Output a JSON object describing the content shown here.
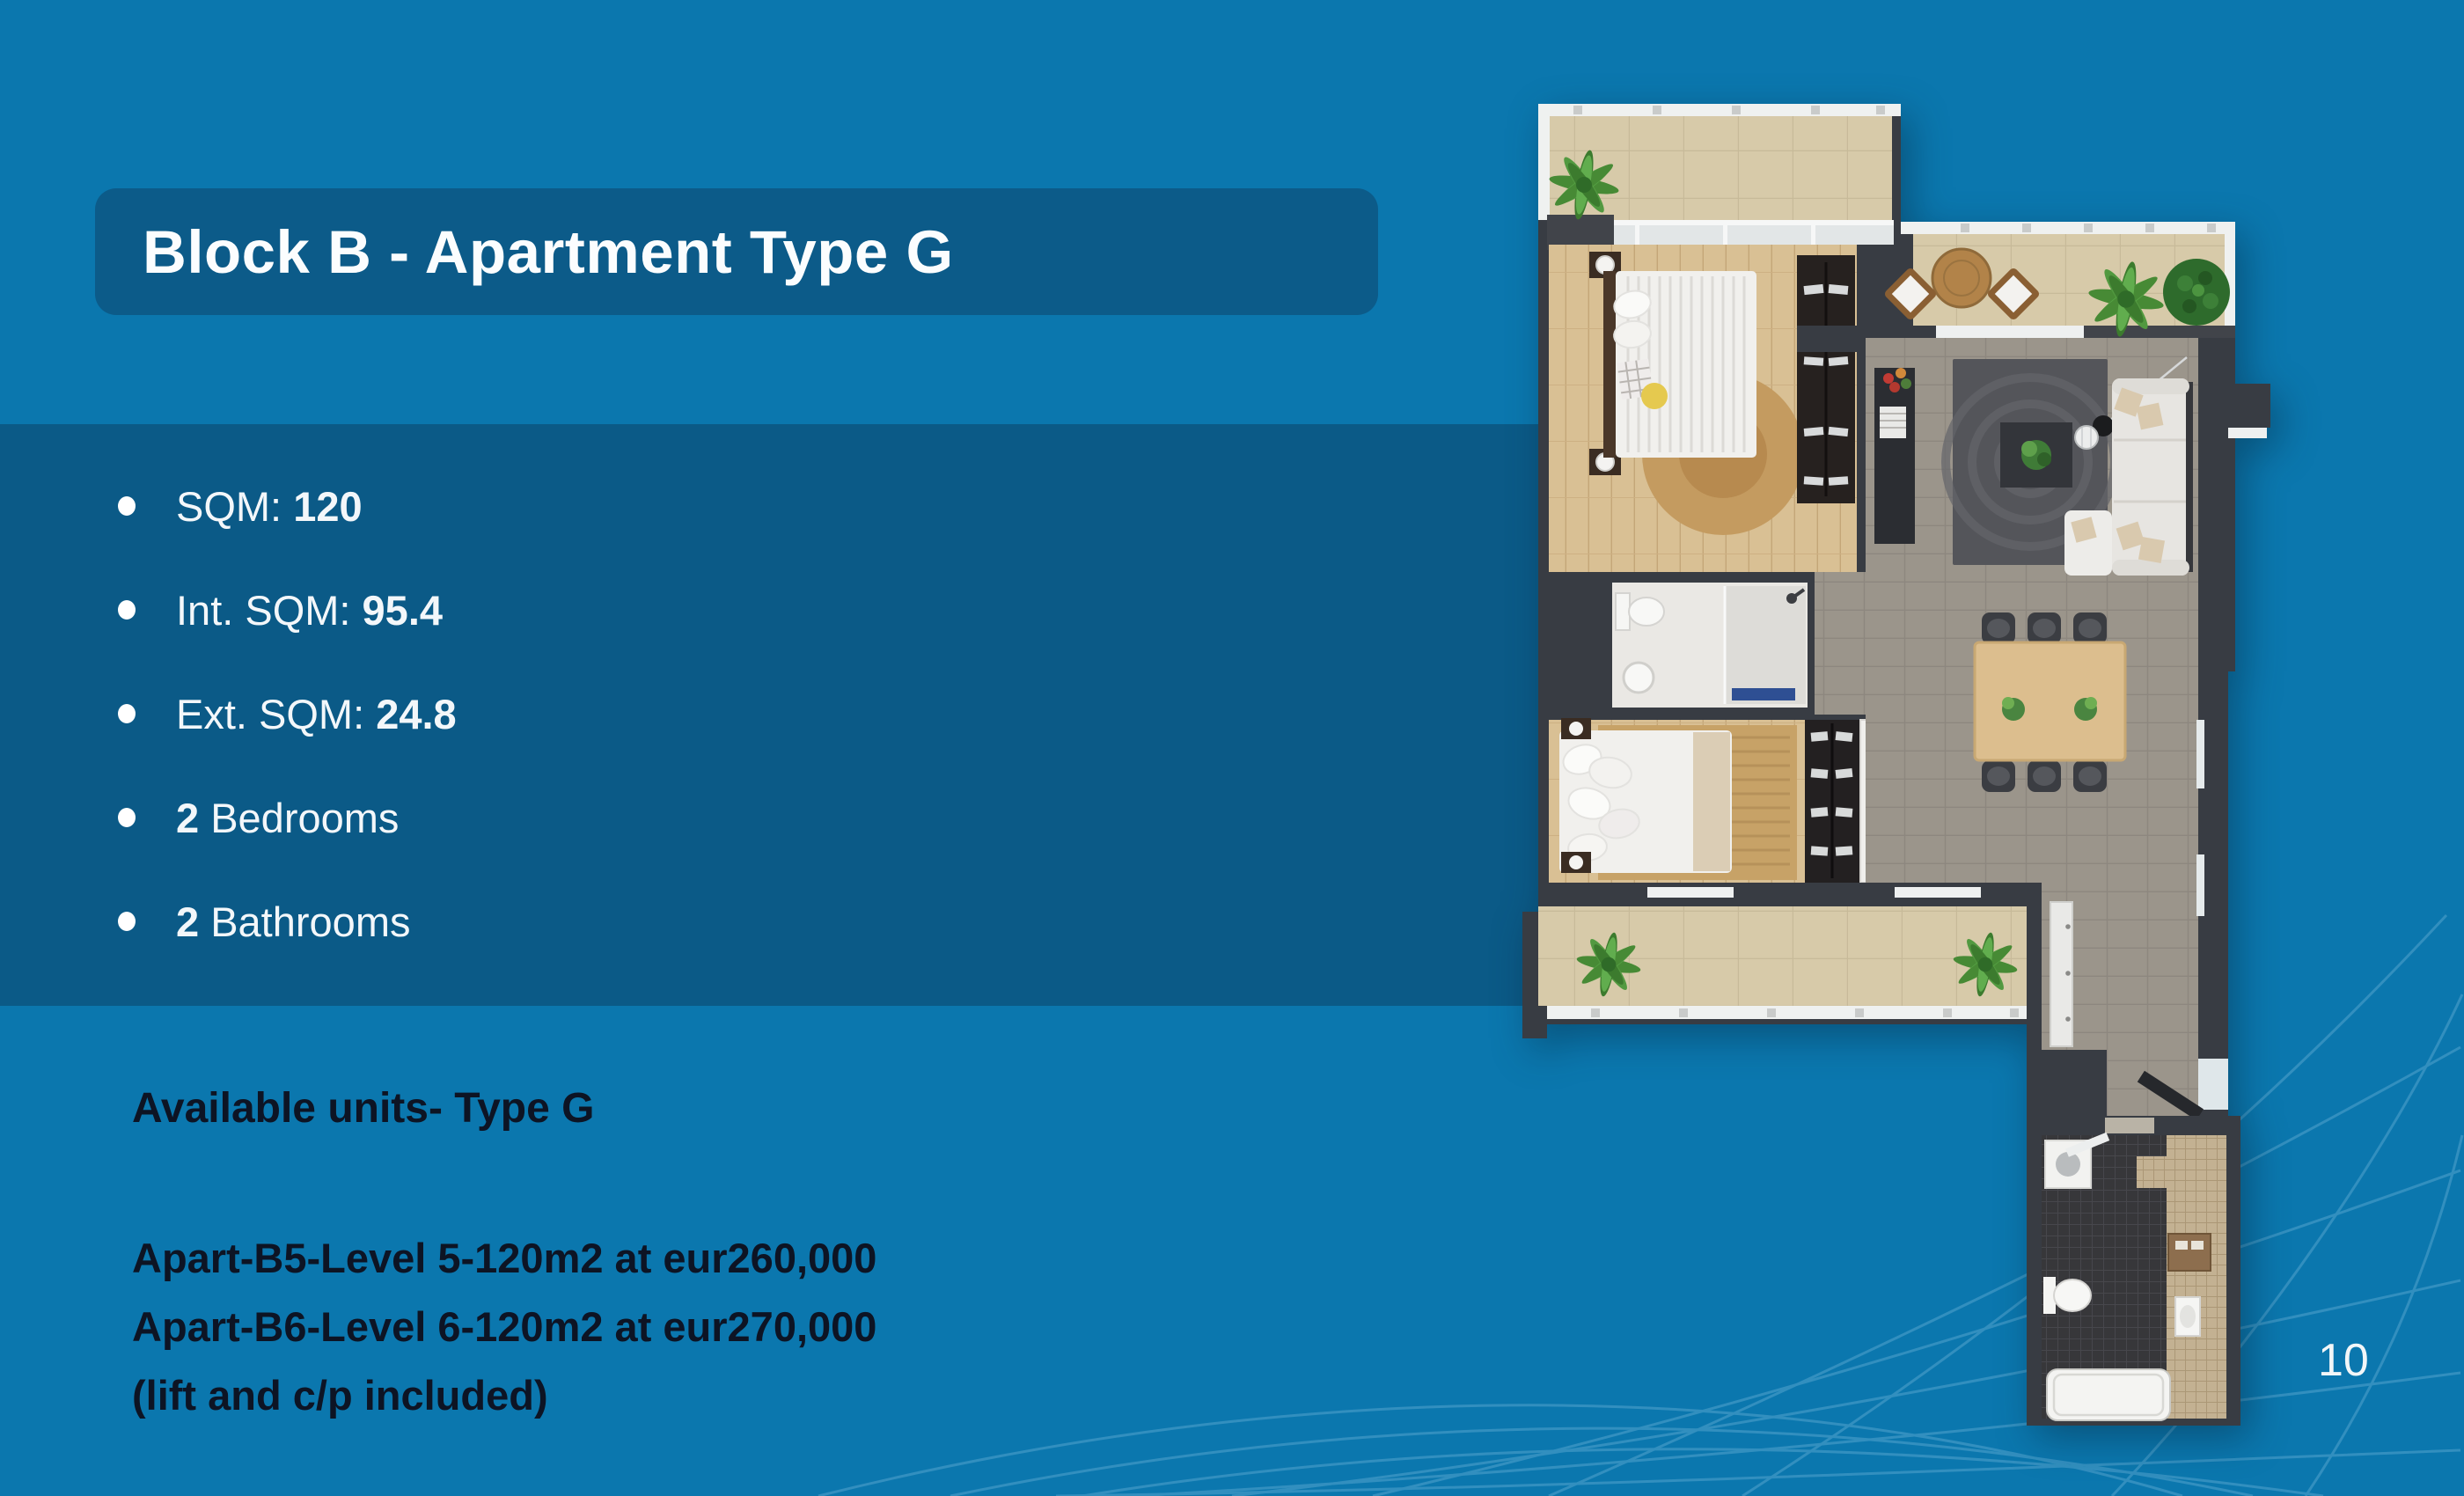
{
  "colors": {
    "background": "#0b77ae",
    "panel": "#0b5a87",
    "title_box": "#0c5b89",
    "title_text": "#fbfdfe",
    "bullet_text": "#f3f7fa",
    "dark_text": "#0d1424",
    "page_number_text": "#f2f6f8",
    "decor_lines": "#63aed4"
  },
  "title": "Block B - Apartment Type G",
  "specs": [
    {
      "pre": "SQM: ",
      "bold": "120",
      "post": ""
    },
    {
      "pre": "Int. SQM: ",
      "bold": "95.4",
      "post": ""
    },
    {
      "pre": "Ext. SQM: ",
      "bold": "24.8",
      "post": ""
    },
    {
      "pre": "",
      "bold": "2",
      "post": " Bedrooms"
    },
    {
      "pre": "",
      "bold": "2",
      "post": " Bathrooms"
    }
  ],
  "availability": {
    "heading": "Available units- Type G",
    "lines": [
      "Apart-B5-Level 5-120m2 at eur260,000",
      "Apart-B6-Level 6-120m2 at eur270,000",
      "(lift and c/p included)"
    ]
  },
  "page_number": "10"
}
